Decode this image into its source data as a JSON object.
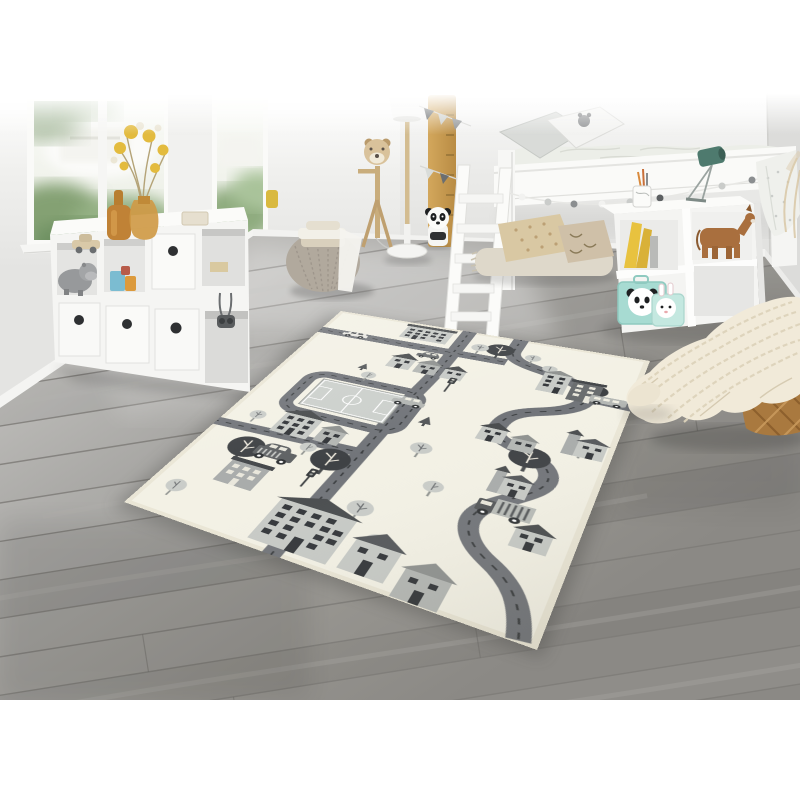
{
  "scene": {
    "label": "Photograph of a Scandinavian children's room with a cream road-map play rug on grey wood flooring",
    "rug": {
      "label": "Cream kids play rug with grey roads, houses, trees, cars and a soccer field",
      "background_color": "#f3f1e5",
      "road_color": "#72757a",
      "road_dash_color": "#3b3e40",
      "motifs": [
        "roads with dashed center lines",
        "soccer field",
        "apartment buildings",
        "pitched-roof houses",
        "church towers",
        "dark round trees",
        "light round trees",
        "pine trees",
        "cars",
        "jeep",
        "truck",
        "bus",
        "traffic lights"
      ]
    },
    "objects": {
      "window": {
        "label": "Windows with white frames and green garden view"
      },
      "sideboard": {
        "label": "White cubby sideboard with drawers, plush hippo and stacking cups"
      },
      "vase": {
        "label": "Amber glass vases with dried yellow flowers"
      },
      "pouf": {
        "label": "Knitted beige pouf with folded cloths"
      },
      "floor_lamp": {
        "label": "Floor lamp with white shade and wooden pole"
      },
      "coat_stand": {
        "label": "Wooden animal-face wall stand"
      },
      "growth_chart": {
        "label": "Wooden growth chart with pennant flags"
      },
      "panda": {
        "label": "Panda toy at the foot of the growth chart"
      },
      "bed": {
        "label": "White mid-sleeper bed with ladder, pillows and pom-pom garland"
      },
      "desk_lamp": {
        "label": "Teal clip desk lamp"
      },
      "pencil_cup": {
        "label": "White cup with orange pencils"
      },
      "cube_shelf": {
        "label": "White cube shelf with yellow books, brown toy horse and mint panda suitcase"
      },
      "cushions": {
        "label": "Beige patterned floor cushions under the bed"
      },
      "basket": {
        "label": "Wicker basket"
      },
      "blanket": {
        "label": "Chunky knit cream blanket draped over the basket"
      },
      "floor": {
        "label": "Grey wide-plank wooden floor"
      }
    },
    "palette": {
      "wall": "#ececea",
      "right_wall": "#dddddb",
      "floor_light": "#c2c1be",
      "floor_dark": "#8b8985",
      "plank_line": "#7e7c78",
      "amber": "#c08236",
      "wood": "#cfa258",
      "mint": "#a7dbd2",
      "teal_lamp": "#4e7a6e",
      "basket_brown": "#a9793f",
      "blanket_cream": "#f1ead9",
      "greenery": "#7e9a6f"
    }
  }
}
